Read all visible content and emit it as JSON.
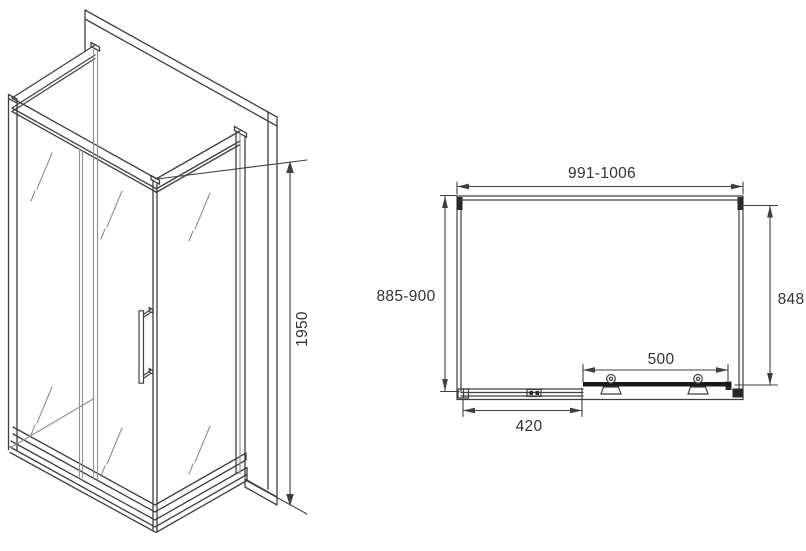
{
  "page": {
    "background": "#ffffff",
    "line_color": "#3f3f3f"
  },
  "drawing": {
    "type": "shower-enclosure-technical-drawing",
    "isometric_view": {
      "height_dim": "1950"
    },
    "plan_view": {
      "top_width_dim": "991-1006",
      "left_depth_dim": "885-900",
      "right_depth_dim": "848",
      "sliding_door_dim": "500",
      "fixed_panel_dim": "420"
    }
  }
}
